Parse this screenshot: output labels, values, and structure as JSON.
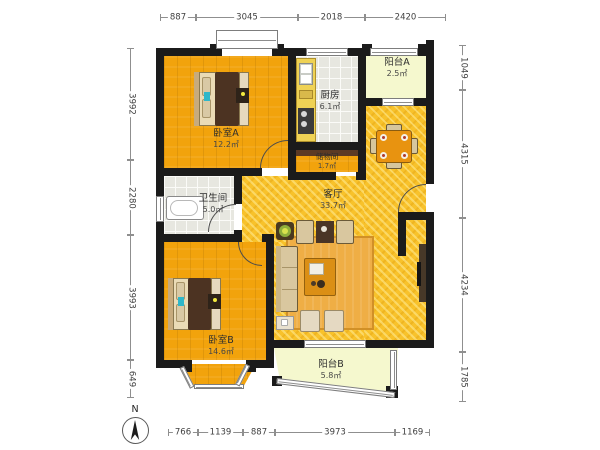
{
  "plan": {
    "compass_label": "N",
    "rooms": [
      {
        "name": "卧室A",
        "area": "12.2㎡"
      },
      {
        "name": "厨房",
        "area": "6.1㎡"
      },
      {
        "name": "阳台A",
        "area": "2.5㎡"
      },
      {
        "name": "储物间",
        "area": "1.7㎡"
      },
      {
        "name": "卫生间",
        "area": "5.0㎡"
      },
      {
        "name": "客厅",
        "area": "33.7㎡"
      },
      {
        "name": "卧室B",
        "area": "14.6㎡"
      },
      {
        "name": "阳台B",
        "area": "5.8㎡"
      }
    ],
    "dimensions": {
      "top": [
        "887",
        "3045",
        "2018",
        "2420"
      ],
      "left": [
        "3992",
        "2280",
        "3993",
        "649"
      ],
      "right": [
        "1049",
        "4315",
        "4234",
        "1785"
      ],
      "bottom": [
        "766",
        "1139",
        "887",
        "3973",
        "1169"
      ]
    }
  }
}
